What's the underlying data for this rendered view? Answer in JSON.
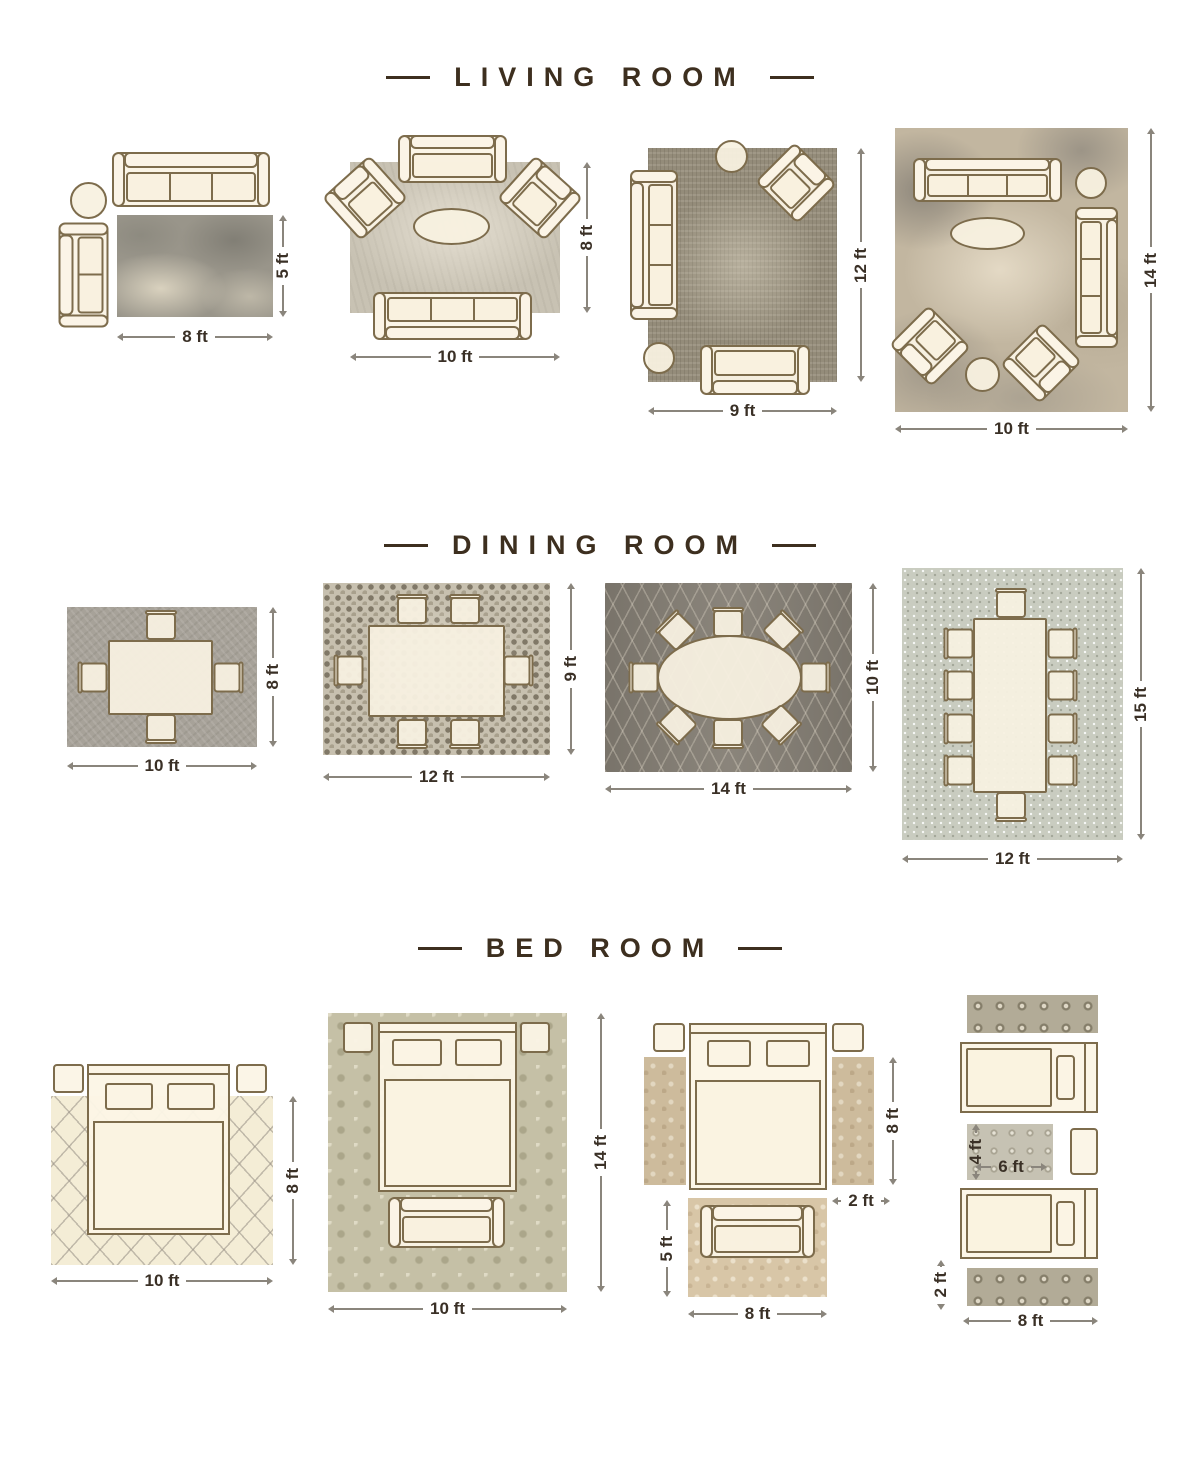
{
  "colors": {
    "background": "#ffffff",
    "title_text": "#3d2f1f",
    "dimension_text": "#3a3026",
    "dimension_line": "#8a857c",
    "furniture_fill": "#fbf4e6",
    "furniture_outline": "#7d6c4c"
  },
  "sections": [
    {
      "title": "LIVING ROOM",
      "layouts": [
        {
          "width": "8 ft",
          "height": "5 ft"
        },
        {
          "width": "10 ft",
          "height": "8 ft"
        },
        {
          "width": "9 ft",
          "height": "12 ft"
        },
        {
          "width": "10 ft",
          "height": "14 ft"
        }
      ]
    },
    {
      "title": "DINING ROOM",
      "layouts": [
        {
          "width": "10 ft",
          "height": "8 ft"
        },
        {
          "width": "12 ft",
          "height": "9 ft"
        },
        {
          "width": "14 ft",
          "height": "10 ft"
        },
        {
          "width": "12 ft",
          "height": "15 ft"
        }
      ]
    },
    {
      "title": "BED ROOM",
      "layouts": [
        {
          "width": "10 ft",
          "height": "8 ft"
        },
        {
          "width": "10 ft",
          "height": "14 ft"
        },
        {
          "bed_height": "8 ft",
          "runner_width": "2 ft",
          "rug_height": "5 ft",
          "rug_width": "8 ft"
        },
        {
          "rug_height": "4 ft",
          "rug_width": "6 ft",
          "runner_height": "2 ft",
          "total_width": "8 ft"
        }
      ]
    }
  ]
}
